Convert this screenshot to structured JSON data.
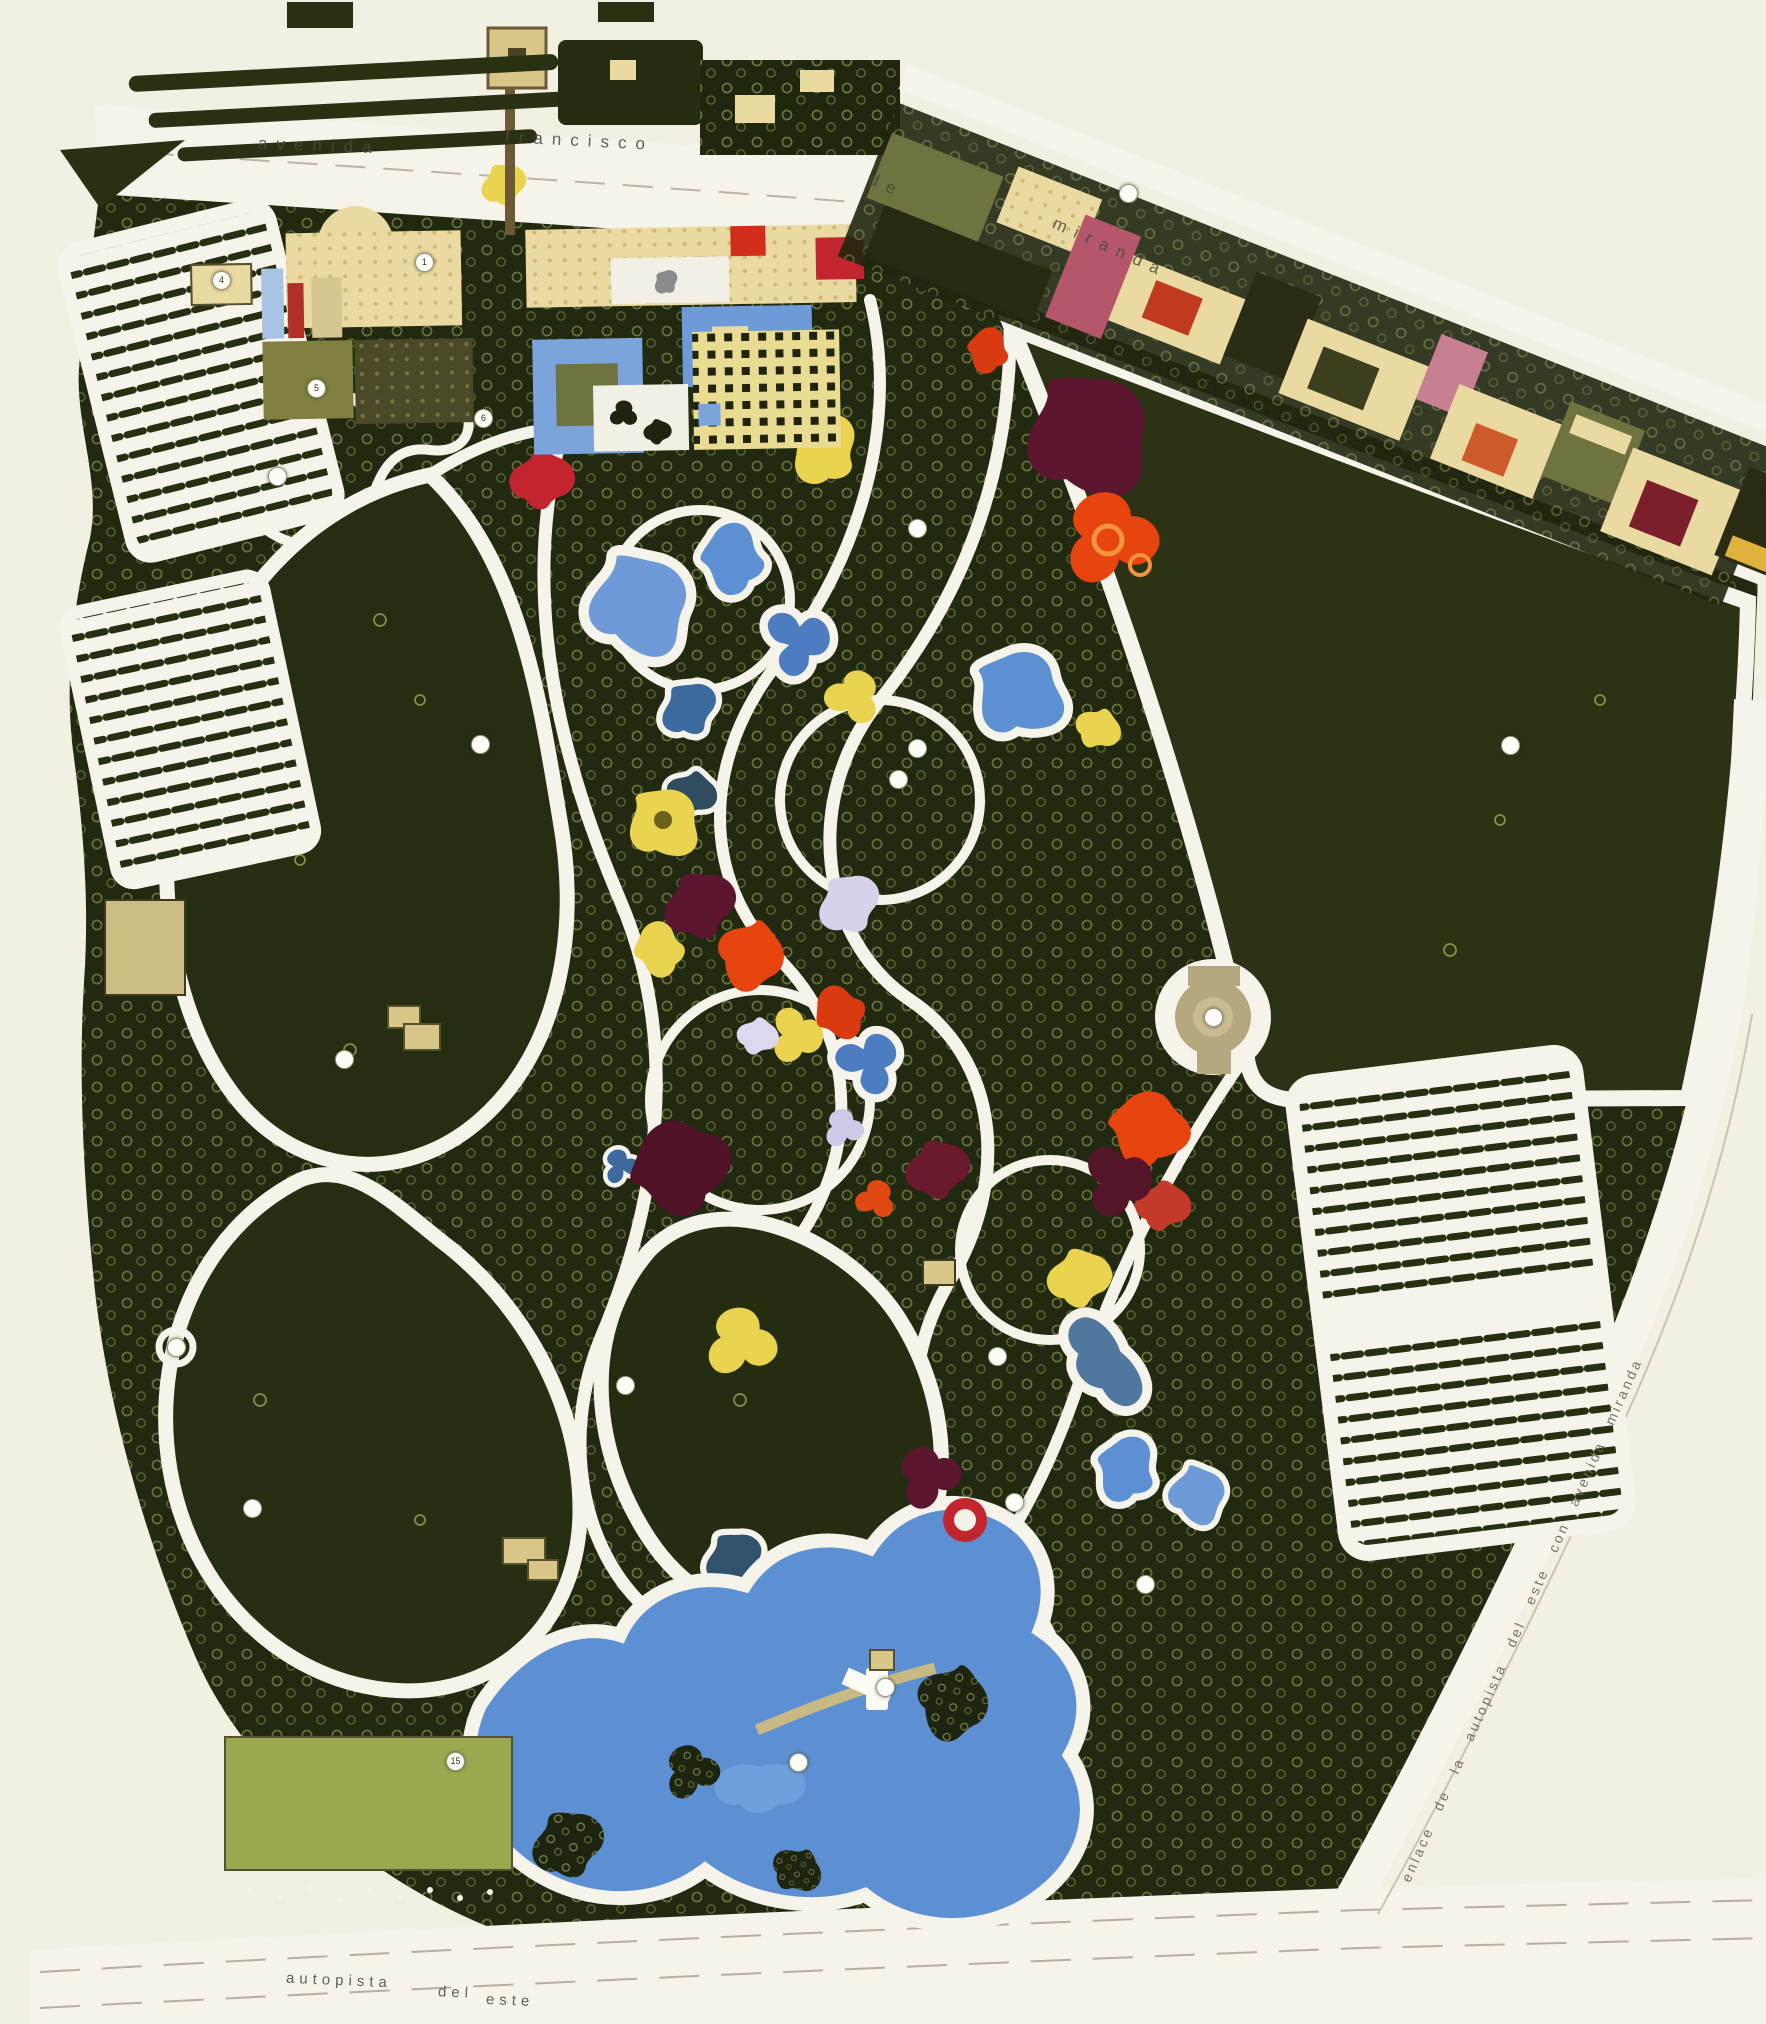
{
  "roads": {
    "top": [
      "avenida",
      "francisco",
      "de",
      "miranda"
    ],
    "bottom": [
      "autopista",
      "del",
      "este"
    ],
    "ramp": "enlace  de  la  autopista  del  este  con  avenida  miranda"
  },
  "markers": [
    {
      "label": "1"
    },
    {
      "label": "4"
    },
    {
      "label": "5"
    },
    {
      "label": "6"
    },
    {
      "label": ""
    },
    {
      "label": ""
    },
    {
      "label": ""
    },
    {
      "label": ""
    },
    {
      "label": ""
    },
    {
      "label": ""
    },
    {
      "label": ""
    },
    {
      "label": ""
    },
    {
      "label": ""
    },
    {
      "label": ""
    },
    {
      "label": ""
    },
    {
      "label": ""
    },
    {
      "label": ""
    },
    {
      "label": ""
    },
    {
      "label": ""
    },
    {
      "label": "15"
    },
    {
      "label": ""
    },
    {
      "label": ""
    }
  ],
  "colors": {
    "paper": "#f2efe3",
    "park_green": "#212a10",
    "meadow_green": "#262e12",
    "field_green": "#2b3314",
    "tree_ring": "#b9c46f",
    "path_white": "#f5f3ea",
    "water_blue": "#5d90d2",
    "water_deep": "#31526b",
    "lake_highlight": "#7fb0e4",
    "bed_red": "#e8440f",
    "bed_crimson": "#c2252e",
    "bed_maroon": "#5c1630",
    "bed_yellow": "#e9d34f",
    "bed_lavender": "#d7d2ec",
    "building_cream": "#ead9a0",
    "plaza_olive": "#7f8040",
    "structure_tan": "#b5a87e"
  }
}
